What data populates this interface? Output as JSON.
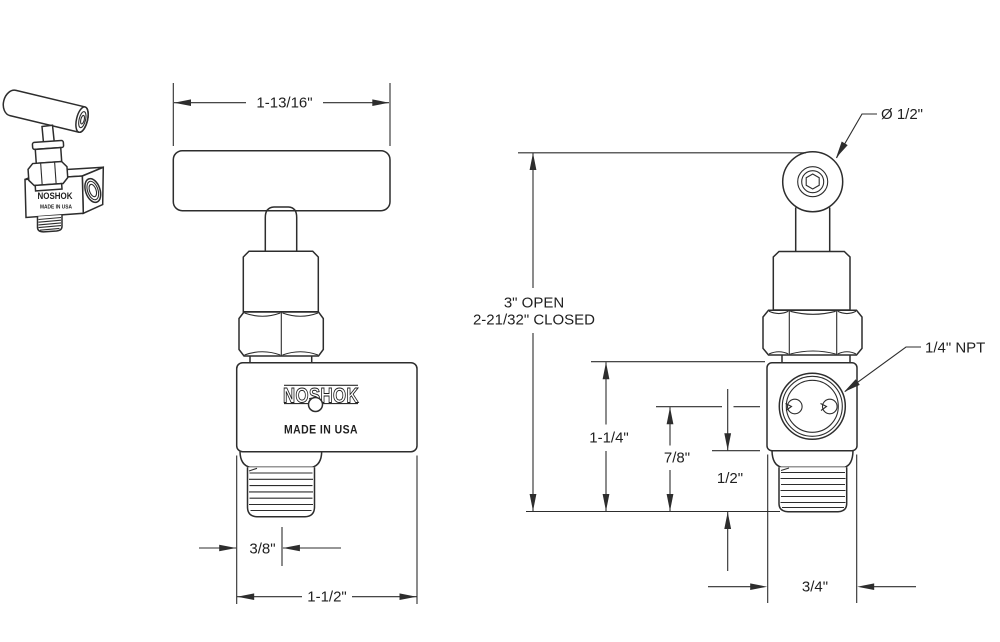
{
  "drawing": {
    "brand": "NOSHOK",
    "made_in": "MADE IN USA",
    "colors": {
      "background": "#ffffff",
      "line": "#2d2d2d"
    },
    "front_view": {
      "dims": {
        "handle_width": "1-13/16\"",
        "inlet_offset": "3/8\"",
        "body_width": "1-1/2\""
      }
    },
    "side_view": {
      "dims": {
        "handle_diameter": "Ø 1/2\"",
        "height_open": "3\" OPEN",
        "height_closed": "2-21/32\" CLOSED",
        "body_height": "1-1/4\"",
        "port_center_height": "7/8\"",
        "thread_length": "1/2\"",
        "body_depth": "3/4\"",
        "port_size": "1/4\" NPT"
      }
    }
  }
}
